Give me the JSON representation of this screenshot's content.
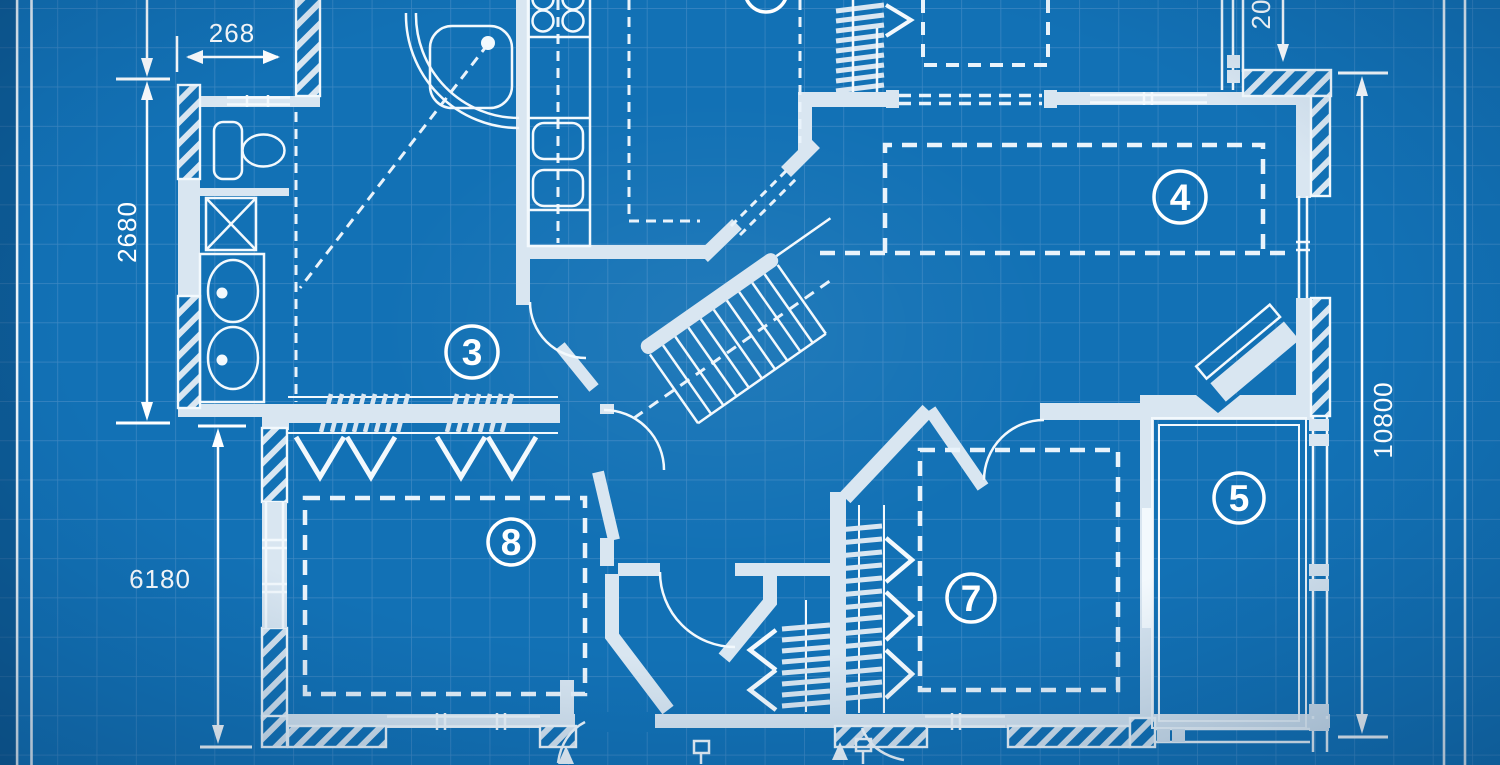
{
  "drawing": {
    "kind": "blueprint floor plan",
    "palette": {
      "paper": "#1271b5",
      "grid_line": "#3e88c3",
      "wall_fill": "#d9e6f1",
      "line": "#f3f9fd",
      "text": "#ffffff"
    }
  },
  "room_labels": {
    "room3": "3",
    "room4": "4",
    "room5": "5",
    "room7": "7",
    "room8": "8"
  },
  "dimension_labels": {
    "bath_width": "268",
    "bath_height": "2680",
    "left_wing_height": "6180",
    "overall_height": "10800",
    "top_right_clipped": "20"
  }
}
